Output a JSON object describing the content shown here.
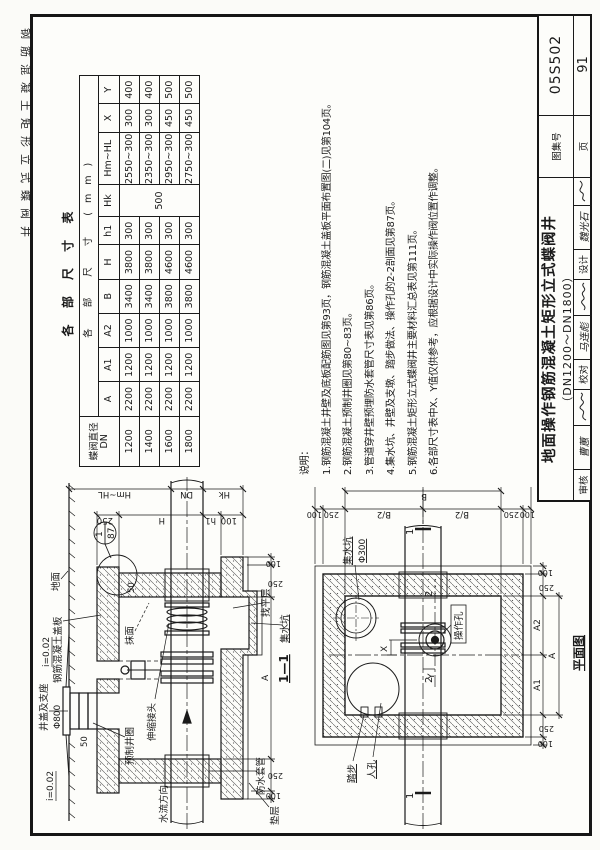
{
  "page": {
    "margin_label": "钢筋混凝土矩形立式蝶阀井"
  },
  "dimension_table": {
    "title": "各 部 尺 寸 表",
    "group_header": "各 部 尺 寸 (mm)",
    "row_header_line1": "蝶阀直径",
    "row_header_line2": "DN",
    "columns": [
      "A",
      "A1",
      "A2",
      "B",
      "H",
      "h1",
      "Hk",
      "Hm~HL",
      "X",
      "Y"
    ],
    "hk_merged_value": "500",
    "rows": [
      {
        "dn": "1200",
        "values": [
          "2200",
          "1200",
          "1000",
          "3400",
          "3800",
          "300",
          "2550~3000",
          "300",
          "400"
        ]
      },
      {
        "dn": "1400",
        "values": [
          "2200",
          "1200",
          "1000",
          "3400",
          "3800",
          "300",
          "2350~3000",
          "300",
          "400"
        ]
      },
      {
        "dn": "1600",
        "values": [
          "2200",
          "1200",
          "1000",
          "3800",
          "4600",
          "300",
          "2950~3000",
          "450",
          "500"
        ]
      },
      {
        "dn": "1800",
        "values": [
          "2200",
          "1200",
          "1000",
          "3800",
          "4600",
          "300",
          "2750~3000",
          "450",
          "500"
        ]
      }
    ]
  },
  "notes": {
    "heading": "说明：",
    "items": [
      "1.钢筋混凝土井壁及底板配筋图见第93页，钢筋混凝土盖板平面布置图(二)见第104页。",
      "2.钢筋混凝土预制井圈见第80~83页。",
      "3.管道穿井壁预埋防水套管尺寸表见第86页。",
      "4.集水坑、井壁及支墩、踏步做法、操作孔的2-2剖面见第87页。",
      "5.钢筋混凝土矩形立式蝶阀井主要材料汇总表见第111页。",
      "6.各部尺寸表中X、Y值仅供参考，应根据设计中实际操作阀位置作调整。"
    ]
  },
  "section_view": {
    "caption": "1—1",
    "labels": {
      "ground": "地面",
      "cover_slab": "钢筋混凝土盖板",
      "detail_no": "1",
      "detail_page": "87",
      "manhole_cover": "井盖及支座",
      "manhole_dia": "Φ800",
      "precast_ring": "预制井圈",
      "plaster": "抹面",
      "slope": "i=0.02",
      "expansion_joint": "伸缩接头",
      "flow_direction": "水流方向",
      "waterproof_sleeve": "防水套管",
      "cushion": "垫层",
      "sump": "集水坑",
      "leveling": "找平层"
    },
    "dims": {
      "d250": "250",
      "d100": "100",
      "d50": "50",
      "A": "A",
      "H": "H",
      "h1": "h1",
      "Hk": "Hk",
      "HmHL": "Hm~HL",
      "DN": "DN"
    }
  },
  "plan_view": {
    "caption": "平面图",
    "labels": {
      "sump": "集水坑",
      "sump_dia": "Φ300",
      "operation_hole": "操作孔",
      "steps": "踏步",
      "manhole": "人孔"
    },
    "dims": {
      "d250": "250",
      "d100": "100",
      "A": "A",
      "A1": "A1",
      "A2": "A2",
      "B": "B",
      "B2": "B/2",
      "X": "X",
      "Y": "Y",
      "cut1": "1",
      "cut2": "2"
    }
  },
  "title_block": {
    "title_line1": "地面操作钢筋混凝土矩形立式蝶阀井",
    "title_line2": "（DN1200～DN1800）",
    "atlas_label": "图集号",
    "atlas_no": "05S502",
    "page_label": "页",
    "page_no": "91",
    "reviewer_label": "审核",
    "reviewer_name": "曹蕙",
    "checker_label": "校对",
    "checker_name": "马连彪",
    "designer_label": "设计",
    "designer_name": "魏光石"
  }
}
